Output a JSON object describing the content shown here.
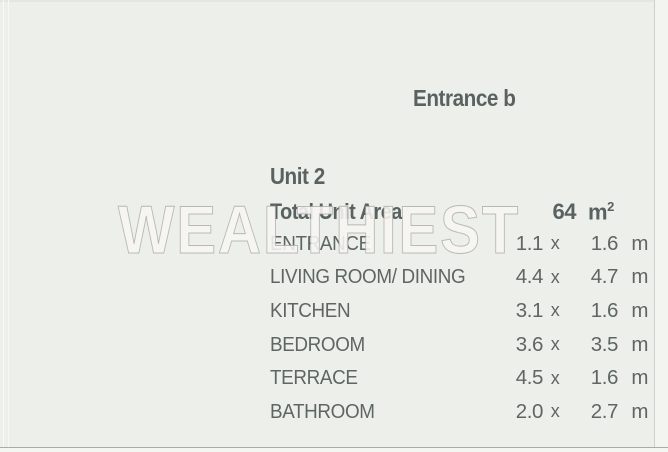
{
  "page": {
    "watermark": "WEALTHIEST",
    "background_color": "#edf0ea",
    "text_color": "#5d6563",
    "watermark_fill": "#f7f5f2",
    "watermark_outline": "#a4a6a0"
  },
  "header": {
    "entrance_label": "Entrance b"
  },
  "unit": {
    "title": "Unit 2",
    "total_area_label": "Total Unit Area",
    "total_area_value": "64",
    "total_area_unit_base": "m",
    "total_area_unit_exponent": "2"
  },
  "rooms": {
    "dimension_separator": "x",
    "dimension_unit": "m",
    "items": [
      {
        "name": "ENTRANCE",
        "width": "1.1",
        "depth": "1.6"
      },
      {
        "name": "LIVING ROOM/ DINING",
        "width": "4.4",
        "depth": "4.7"
      },
      {
        "name": "KITCHEN",
        "width": "3.1",
        "depth": "1.6"
      },
      {
        "name": "BEDROOM",
        "width": "3.6",
        "depth": "3.5"
      },
      {
        "name": "TERRACE",
        "width": "4.5",
        "depth": "1.6"
      },
      {
        "name": "BATHROOM",
        "width": "2.0",
        "depth": "2.7"
      }
    ]
  }
}
